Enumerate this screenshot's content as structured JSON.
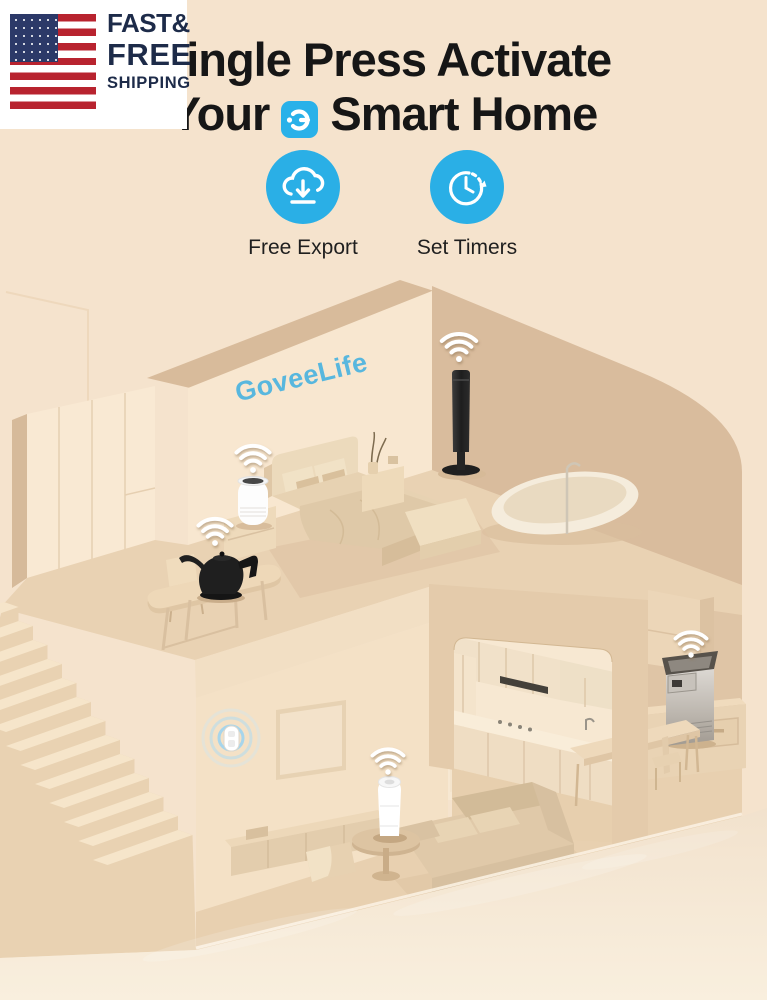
{
  "shipping_badge": {
    "flag_icon": "us-flag-icon",
    "line1": "FAST&",
    "line2": "FREE",
    "line3": "SHIPPING"
  },
  "headline": {
    "line1": "Single Press Activate",
    "line2_before_icon": "Your",
    "brand_icon": "govee-app-icon",
    "line2_after_icon": "Smart Home"
  },
  "features": [
    {
      "icon": "cloud-download-icon",
      "label": "Free Export"
    },
    {
      "icon": "set-timer-icon",
      "label": "Set Timers"
    }
  ],
  "scene": {
    "wall_logo_text": "GoveeLife",
    "wifi_indicator": "wifi-icon",
    "devices": [
      "smart-air-purifier-bedroom",
      "smart-kettle",
      "smart-tower-fan",
      "smart-button",
      "smart-humidifier-living-room",
      "smart-ice-maker"
    ]
  },
  "colors": {
    "background": "#f5e3cd",
    "accent_blue": "#29b0e8",
    "logo_blue": "#58b7de",
    "headline_text": "#161616",
    "badge_text_navy": "#1d2b49",
    "flag_red": "#b8232f",
    "flag_canton_navy": "#2c3968"
  }
}
